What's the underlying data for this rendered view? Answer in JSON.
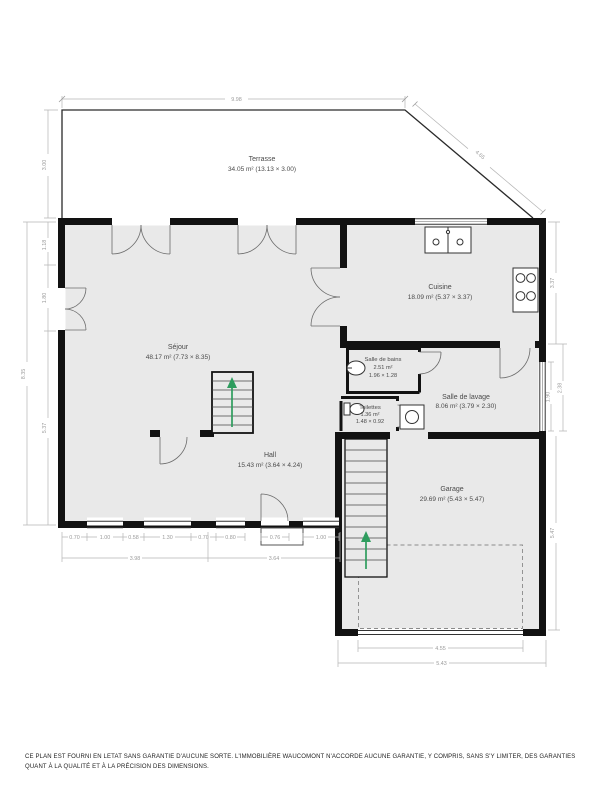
{
  "rooms": {
    "terrasse": {
      "name": "Terrasse",
      "details": "34.05 m² (13.13 × 3.00)"
    },
    "sejour": {
      "name": "Séjour",
      "details": "48.17 m² (7.73 × 8.35)"
    },
    "cuisine": {
      "name": "Cuisine",
      "details": "18.09 m² (5.37 × 3.37)"
    },
    "salle_de_bains": {
      "name": "Salle de bains",
      "area": "2.51 m²",
      "dims": "1.96 × 1.28"
    },
    "toilettes": {
      "name": "Toilettes",
      "area": "1.36 m²",
      "dims": "1.48 × 0.92"
    },
    "salle_de_lavage": {
      "name": "Salle de lavage",
      "details": "8.06 m² (3.79 × 2.30)"
    },
    "hall": {
      "name": "Hall",
      "details": "15.43 m² (3.64 × 4.24)"
    },
    "garage": {
      "name": "Garage",
      "details": "29.69 m² (5.43 × 5.47)"
    }
  },
  "dimensions": {
    "terrace_top": "9.98",
    "terrace_diagonal": "4.65",
    "terrace_left": "3.00",
    "left_outer": "8.35",
    "left_upper": "1.18",
    "left_mid": "1.80",
    "left_lower": "5.37",
    "right_cuisine": "3.37",
    "right_window": "1.90",
    "right_lavage": "2.38",
    "right_garage": "5.47",
    "bottom_segments": [
      "0.70",
      "1.00",
      "0.58",
      "1.30",
      "0.70",
      "0.80",
      "0.76",
      "1.00"
    ],
    "bottom_sejour": "3.98",
    "bottom_hall": "3.64",
    "garage_door": "4.55",
    "garage_width": "5.43"
  },
  "colors": {
    "wall": "#121212",
    "room_fill": "#e9e9e9",
    "dimension": "#9b9b9b",
    "stairs_arrow": "#2e9c5e"
  },
  "disclaimer": "CE PLAN EST FOURNI EN LETAT SANS GARANTIE D'AUCUNE SORTE. L'IMMOBILIÈRE WAUCOMONT N'ACCORDE AUCUNE GARANTIE, Y COMPRIS, SANS S'Y LIMITER, DES GARANTIES QUANT À LA QUALITÉ ET À LA PRÉCISION DES DIMENSIONS."
}
